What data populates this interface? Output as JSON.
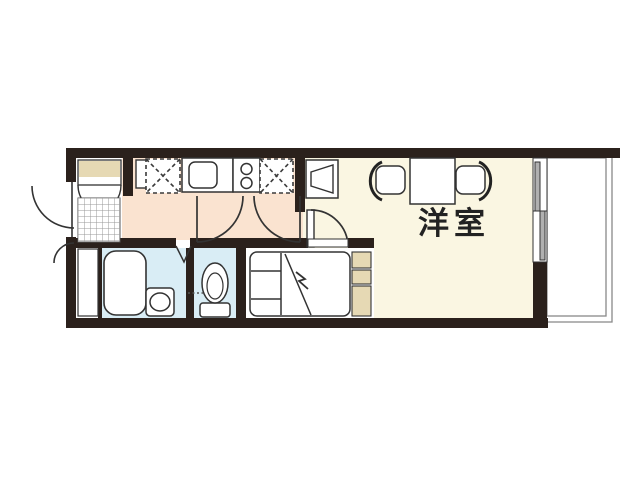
{
  "floorplan": {
    "rooms": {
      "western_room": {
        "label": "洋室"
      }
    },
    "colors": {
      "wall": "#2b211c",
      "hallway_floor": "#fae3d0",
      "western_room_floor": "#faf6e2",
      "wet_area_floor": "#d9edf5",
      "cabinet_fill": "#e6d9b4",
      "fixture_outline": "#333333",
      "window_pane": "#b0b0b0",
      "balcony_line": "#888888",
      "tile_grid_line": "#999999"
    },
    "fixtures": [
      "entrance-door",
      "shoe-cabinet",
      "genkan-tile-floor",
      "refrigerator-space",
      "kitchen-sink",
      "gas-stove",
      "refrigerator-space-2",
      "washing-machine-space",
      "hall-door-left",
      "hall-door-right",
      "room-door",
      "table",
      "chair-left",
      "chair-right",
      "bathtub",
      "washbasin",
      "folding-door",
      "toilet",
      "bed",
      "shelf-unit",
      "sliding-window",
      "balcony"
    ]
  }
}
